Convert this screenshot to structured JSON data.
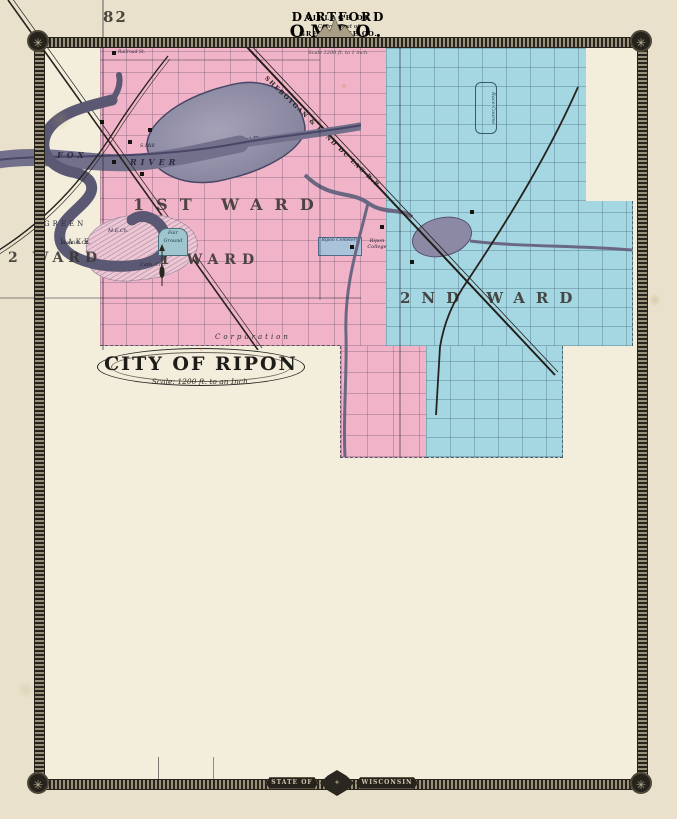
{
  "page": {
    "number": "82"
  },
  "icons": {
    "rosette": "✳",
    "emblem": "✦"
  },
  "banner": {
    "left": "STATE OF",
    "right": "WISCONSIN"
  },
  "ripon": {
    "title": "CITY OF RIPON",
    "scale": "Scale: 1200 ft. to an Inch.",
    "ward1": "1ST WARD",
    "ward2": "2ND WARD",
    "corporation": "Corporation",
    "mill_pond": "MILL POND",
    "railroad": "SHEBOYGAN & FOND DU LAC R.R.",
    "cemetery": "Ripon Cemetery",
    "college": "Ripon College",
    "race_course": "Race Course",
    "colors": {
      "ward1": "#f1b3c7",
      "ward2": "#a5d7e2"
    }
  },
  "omro": {
    "heading": "VILLAGE OF",
    "title": "OMRO.",
    "subtitle": "WINNEBAGO Co.Wis.",
    "scale": "Scale 1200 ft. to 1 inch.",
    "river_word1": "FOX",
    "river_word2": "RIVER",
    "ward2": "2 WARD",
    "ward1": "1 WARD",
    "fair_ground": "Fair Ground",
    "mill": "S.Mill",
    "methodist": "M.E.Ch.",
    "baptist": "Baptist Ch.",
    "catholic": "Cath. Ch."
  },
  "dartford": {
    "title": "DARTFORD",
    "seat": "County Seat of",
    "county": "GREEN LAKE CO.",
    "scale": "Scale 2000 ft. to 1 inch.",
    "street": "Railroad St.",
    "lake_word1": "GREEN",
    "lake_word2": "LAKE"
  }
}
